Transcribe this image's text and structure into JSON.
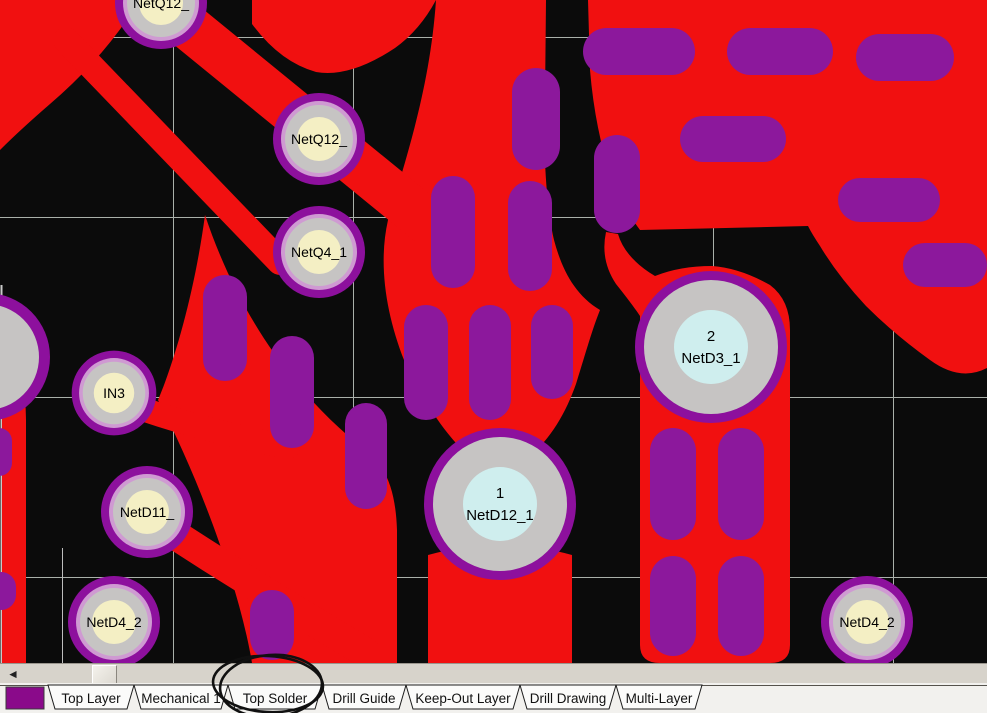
{
  "app": {
    "type": "pcb-layout-editor"
  },
  "colors": {
    "canvas_bg": "#0b0b0b",
    "copper_red": "#f11010",
    "mask_purple": "#8c189c",
    "pad_ring_purple": "#8d109d",
    "pad_ring_plum": "#cf9ad2",
    "pad_silver": "#c6c4c3",
    "pad_inner_yellow": "#f4efc4",
    "pad_inner_cyan": "#cfeeee",
    "grid_gray": "#aab0aa",
    "swatch_purple": "#8a0a8a",
    "tab_fill": "#fbfbfa",
    "annotation_ink": "#101010"
  },
  "grid": {
    "vertical_x": [
      173,
      353,
      533,
      713,
      893
    ],
    "horizontal_y": [
      37,
      217,
      397,
      577
    ]
  },
  "pads": {
    "small": [
      {
        "label": "NetQ12_",
        "x": 161,
        "y": 3
      },
      {
        "label": "NetQ12_",
        "x": 319,
        "y": 139
      },
      {
        "label": "NetQ4_1",
        "x": 319,
        "y": 252
      },
      {
        "label": "IN3",
        "x": 114,
        "y": 393
      },
      {
        "label": "NetD11_",
        "x": 147,
        "y": 512
      },
      {
        "label": "NetD4_2",
        "x": 114,
        "y": 622
      },
      {
        "label": "NetD4_2",
        "x": 867,
        "y": 622
      }
    ],
    "edge": [
      {
        "label": "",
        "x": -14,
        "y": 357
      }
    ],
    "large": [
      {
        "number": "1",
        "label": "NetD12_1",
        "x": 500,
        "y": 504
      },
      {
        "number": "2",
        "label": "NetD3_1",
        "x": 711,
        "y": 347
      }
    ]
  },
  "pills": [
    {
      "x": -14,
      "y": 428,
      "w": 26,
      "h": 48
    },
    {
      "x": -14,
      "y": 572,
      "w": 30,
      "h": 38
    },
    {
      "x": 203,
      "y": 275,
      "w": 44,
      "h": 106
    },
    {
      "x": 270,
      "y": 336,
      "w": 44,
      "h": 112
    },
    {
      "x": 345,
      "y": 403,
      "w": 42,
      "h": 106
    },
    {
      "x": 250,
      "y": 590,
      "w": 44,
      "h": 70
    },
    {
      "x": 512,
      "y": 68,
      "w": 48,
      "h": 102
    },
    {
      "x": 431,
      "y": 176,
      "w": 44,
      "h": 112
    },
    {
      "x": 508,
      "y": 181,
      "w": 44,
      "h": 110
    },
    {
      "x": 404,
      "y": 305,
      "w": 44,
      "h": 115
    },
    {
      "x": 469,
      "y": 305,
      "w": 42,
      "h": 115
    },
    {
      "x": 531,
      "y": 305,
      "w": 42,
      "h": 94
    },
    {
      "x": 594,
      "y": 135,
      "w": 46,
      "h": 98
    },
    {
      "x": 583,
      "y": 28,
      "w": 112,
      "h": 47
    },
    {
      "x": 727,
      "y": 28,
      "w": 106,
      "h": 47
    },
    {
      "x": 856,
      "y": 34,
      "w": 98,
      "h": 47
    },
    {
      "x": 680,
      "y": 116,
      "w": 106,
      "h": 46
    },
    {
      "x": 838,
      "y": 178,
      "w": 102,
      "h": 44
    },
    {
      "x": 903,
      "y": 243,
      "w": 84,
      "h": 44
    },
    {
      "x": 650,
      "y": 428,
      "w": 46,
      "h": 112
    },
    {
      "x": 718,
      "y": 428,
      "w": 46,
      "h": 112
    },
    {
      "x": 650,
      "y": 556,
      "w": 46,
      "h": 100
    },
    {
      "x": 718,
      "y": 556,
      "w": 46,
      "h": 100
    }
  ],
  "scrollbar": {
    "left_arrow": "◄"
  },
  "layer_tabs": {
    "swatch_color": "#8a0a8a",
    "tabs": [
      {
        "label": "Top Layer"
      },
      {
        "label": "Mechanical 1"
      },
      {
        "label": "Top Solder"
      },
      {
        "label": "Drill Guide"
      },
      {
        "label": "Keep-Out Layer"
      },
      {
        "label": "Drill Drawing"
      },
      {
        "label": "Multi-Layer"
      }
    ],
    "circled_tab": "Top Solder"
  },
  "annotation": {
    "type": "hand-drawn-circle",
    "around": "Top Solder"
  }
}
